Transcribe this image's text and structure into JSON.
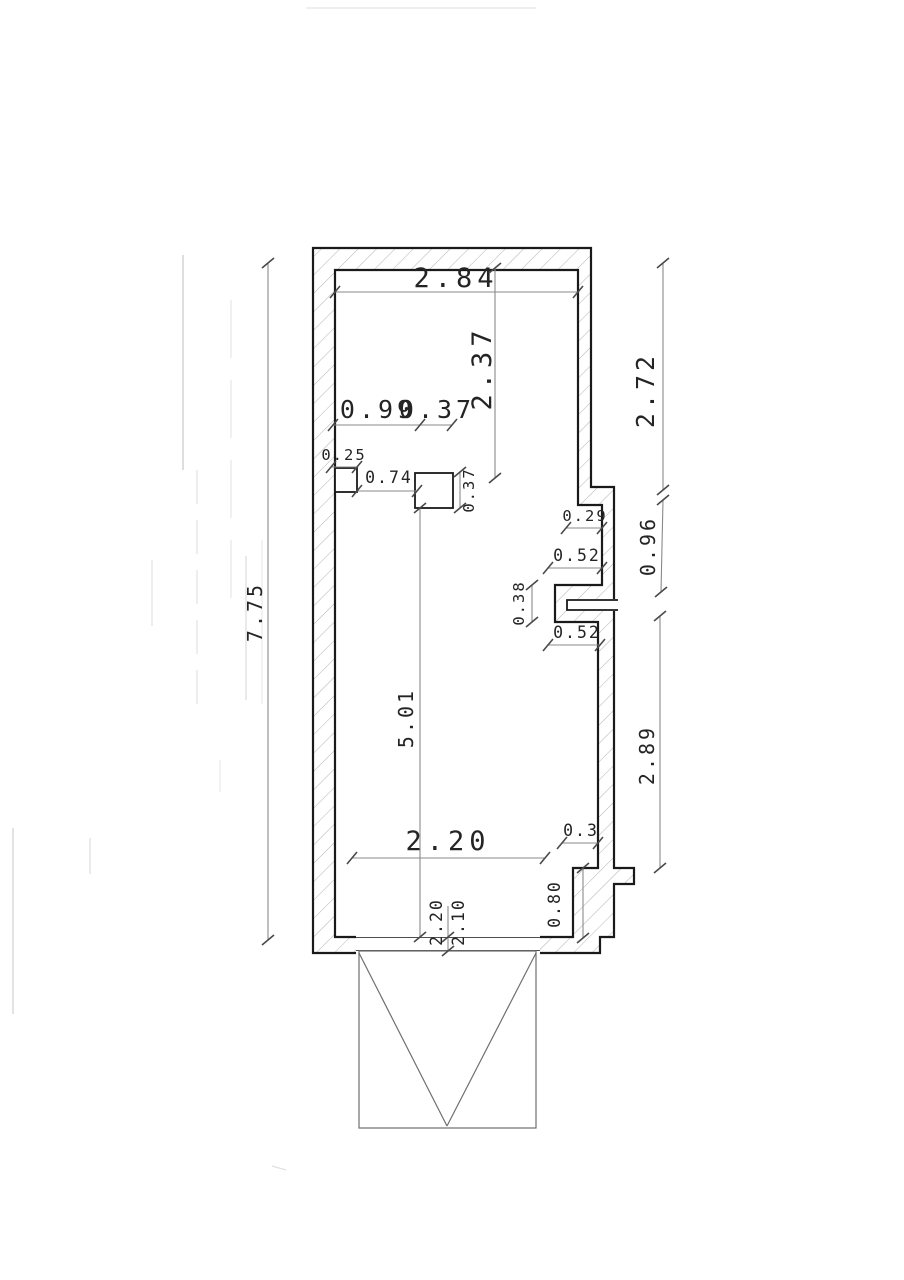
{
  "drawing": {
    "kind": "scanned floor plan with garage door symbol",
    "dim_labels": {
      "top_width": "2.84",
      "top_interior_height": "2.37",
      "offset_a": "0.99",
      "offset_b": "0.37",
      "left_niche_width": "0.25",
      "niche_gap": "0.74",
      "column_depth": "0.37",
      "flue_offset": "0.29",
      "flue_upper_width": "0.52",
      "flue_slot_height": "0.38",
      "flue_lower_width": "0.52",
      "interior_length": "5.01",
      "left_total_height": "7.75",
      "right_upper_height": "2.72",
      "right_flue_height": "0.96",
      "right_lower_height": "2.89",
      "bottom_interior_width": "2.20",
      "bottom_right_offset": "0.3",
      "bottom_step_height": "0.80",
      "door_opening_width": "2.20",
      "door_leaf_width": "2.10"
    }
  },
  "colors": {
    "wall_line": "#1a1a1a",
    "dim_line": "#8a8a8a",
    "tick_line": "#4a4a4a",
    "hatch_line": "#b3b3b3",
    "text": "#242424",
    "paper": "#ffffff",
    "artifact": "#9a9a9a",
    "door_line": "#6f6f6f"
  }
}
